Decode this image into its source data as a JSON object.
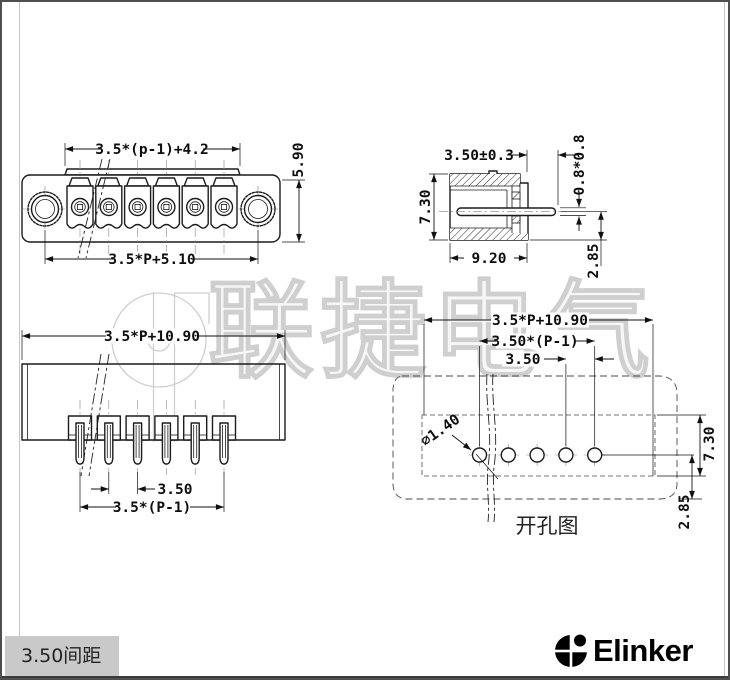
{
  "colors": {
    "line": "#1c1c1c",
    "watermark": "#cfcfcf",
    "panel_box_bg": "#c9c9c9",
    "footer_bar": "#3b3b3b",
    "paper": "#ffffff"
  },
  "watermark": {
    "text": "联捷电气",
    "logo": "elinker-circle-logo"
  },
  "views": {
    "front": {
      "name": "front-view",
      "dims": {
        "top": "3.5*(p-1)+4.2",
        "height": "5.90",
        "bottom": "3.5*P+5.10"
      }
    },
    "side": {
      "name": "side-section-view",
      "dims": {
        "pin_len": "3.50±0.3",
        "pin_sec": "0.8*0.8",
        "height": "7.30",
        "depth": "9.20",
        "offset": "2.85"
      }
    },
    "rear": {
      "name": "rear-view",
      "dims": {
        "width": "3.5*P+10.90",
        "pitch": "3.50",
        "pitch_span": "3.5*(P-1)"
      }
    },
    "drill": {
      "name": "panel-cutout-view",
      "caption": "开孔图",
      "dims": {
        "width": "3.5*P+10.90",
        "pitch_span": "3.50*(P-1)",
        "pitch": "3.50",
        "hole_dia": "⌀1.40",
        "height": "7.30",
        "offset": "2.85"
      }
    }
  },
  "footer": {
    "pitch_label": "3.50间距",
    "brand": "Elinker"
  }
}
